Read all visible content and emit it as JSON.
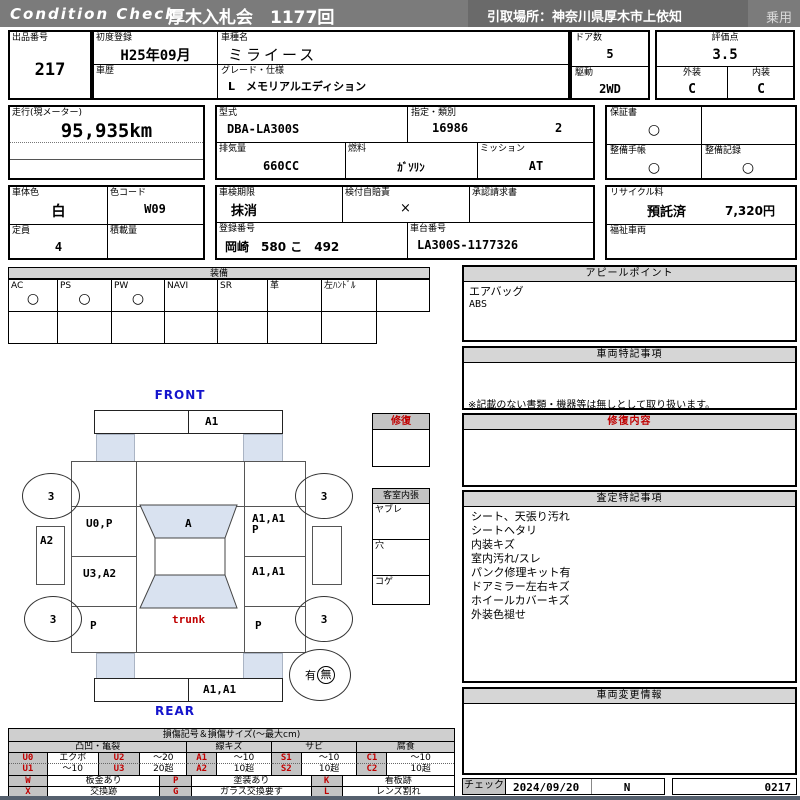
{
  "header": {
    "brand": "Condition Check",
    "auction_title": "厚木入札会　1177回",
    "pickup_location": "引取場所：神奈川県厚木市上依知",
    "vehicle_category": "乗用"
  },
  "fields": {
    "exhibit_no": {
      "label": "出品番号",
      "value": "217"
    },
    "first_registration": {
      "label": "初度登録",
      "value": "H25年09月"
    },
    "vehicle_history": {
      "label": "車歴",
      "value": ""
    },
    "model_name": {
      "label": "車種名",
      "value": "ミライース"
    },
    "grade": {
      "label": "グレード・仕様",
      "value": "L　メモリアルエディション"
    },
    "doors": {
      "label": "ドア数",
      "value": "5"
    },
    "drive": {
      "label": "駆動",
      "value": "2WD"
    },
    "score": {
      "label": "評価点",
      "value": "3.5"
    },
    "exterior": {
      "label": "外装",
      "value": "C"
    },
    "interior": {
      "label": "内装",
      "value": "C"
    },
    "mileage": {
      "label": "走行(現メーター)",
      "value": "95,935km"
    },
    "model_code": {
      "label": "型式",
      "value": "DBA-LA300S"
    },
    "designation": {
      "label": "指定・類別",
      "value1": "16986",
      "value2": "2"
    },
    "displacement": {
      "label": "排気量",
      "value": "660CC"
    },
    "fuel": {
      "label": "燃料",
      "value": "ｶﾞｿﾘﾝ"
    },
    "transmission": {
      "label": "ミッション",
      "value": "AT"
    },
    "warranty": {
      "label": "保証書",
      "value": "○"
    },
    "maintenance_book": {
      "label": "整備手帳",
      "value": "○"
    },
    "maintenance_record": {
      "label": "整備記録",
      "value": "○"
    },
    "body_color": {
      "label": "車体色",
      "value": "白"
    },
    "color_code": {
      "label": "色コード",
      "value": "W09"
    },
    "capacity": {
      "label": "定員",
      "value": "4"
    },
    "load_capacity": {
      "label": "積載量",
      "value": ""
    },
    "inspection_expiry": {
      "label": "車検期限",
      "value": "抹消"
    },
    "insurance": {
      "label": "検付自賠責",
      "value": "×"
    },
    "approval_request": {
      "label": "承認請求書",
      "value": ""
    },
    "recycle_fee": {
      "label": "リサイクル料",
      "value1": "預託済",
      "value2": "7,320円"
    },
    "registration_no": {
      "label": "登録番号",
      "value": "岡崎　580 こ　492"
    },
    "chassis_no": {
      "label": "車台番号",
      "value": "LA300S-1177326"
    },
    "welfare_vehicle": {
      "label": "福祉車両",
      "value": ""
    }
  },
  "equipment": {
    "title": "装備",
    "items": [
      {
        "label": "AC",
        "mark": "○"
      },
      {
        "label": "PS",
        "mark": "○"
      },
      {
        "label": "PW",
        "mark": "○"
      },
      {
        "label": "NAVI",
        "mark": ""
      },
      {
        "label": "SR",
        "mark": ""
      },
      {
        "label": "革",
        "mark": ""
      },
      {
        "label": "左ﾊﾝﾄﾞﾙ",
        "mark": ""
      }
    ]
  },
  "appeal": {
    "title": "アピールポイント",
    "lines": [
      "エアバッグ",
      "ABS"
    ]
  },
  "vehicle_notes": {
    "title": "車両特記事項",
    "note": "※記載のない書類・機器等は無しとして取り扱います。"
  },
  "repair_detail": {
    "title": "修復内容",
    "content": ""
  },
  "assessment": {
    "title": "査定特記事項",
    "lines": [
      "シート、天張り汚れ",
      "シートヘタリ",
      "内装キズ",
      "室内汚れ/スレ",
      "パンク修理キット有",
      "ドアミラー左右キズ",
      "ホイールカバーキズ",
      "外装色褪せ"
    ]
  },
  "change_info": {
    "title": "車両変更情報",
    "content": ""
  },
  "check": {
    "label": "チェック",
    "date": "2024/09/20",
    "inspector": "N",
    "number": "0217"
  },
  "diagram": {
    "front_label": "FRONT",
    "rear_label": "REAR",
    "front_bumper": "A1",
    "rear_bumper": "A1,A1",
    "wheel_front_left": "3",
    "wheel_front_right": "3",
    "wheel_rear_left": "3",
    "wheel_rear_right": "3",
    "left_front_door": "U0,P",
    "right_front_door_line1": "A1,A1",
    "right_front_door_line2": "P",
    "left_rear_door": "U3,A2",
    "right_rear_door": "A1,A1",
    "left_quarter": "P",
    "right_quarter": "P",
    "windshield": "A",
    "trunk_label": "trunk",
    "left_mirror": "A2",
    "repair_box_title": "修復",
    "cabin": {
      "title": "客室内張",
      "items": [
        "ヤブレ",
        "穴",
        "コゲ"
      ]
    },
    "accident": {
      "yes": "有",
      "no": "無"
    }
  },
  "legend": {
    "title": "損傷記号＆損傷サイズ(～最大cm)",
    "groups": [
      "凸凹・亀裂",
      "線キズ",
      "サビ",
      "腐食"
    ],
    "row1": [
      "U0",
      "エクボ",
      "U2",
      "～20",
      "A1",
      "～10",
      "S1",
      "～10",
      "C1",
      "～10"
    ],
    "row2": [
      "U1",
      "～10",
      "U3",
      "20超",
      "A2",
      "10超",
      "S2",
      "10超",
      "C2",
      "10超"
    ],
    "marks_row1": [
      "W",
      "板金あり",
      "P",
      "塗装あり",
      "K",
      "看板跡"
    ],
    "marks_row2": [
      "X",
      "交換跡",
      "G",
      "ガラス交換要す",
      "L",
      "レンズ割れ"
    ]
  }
}
